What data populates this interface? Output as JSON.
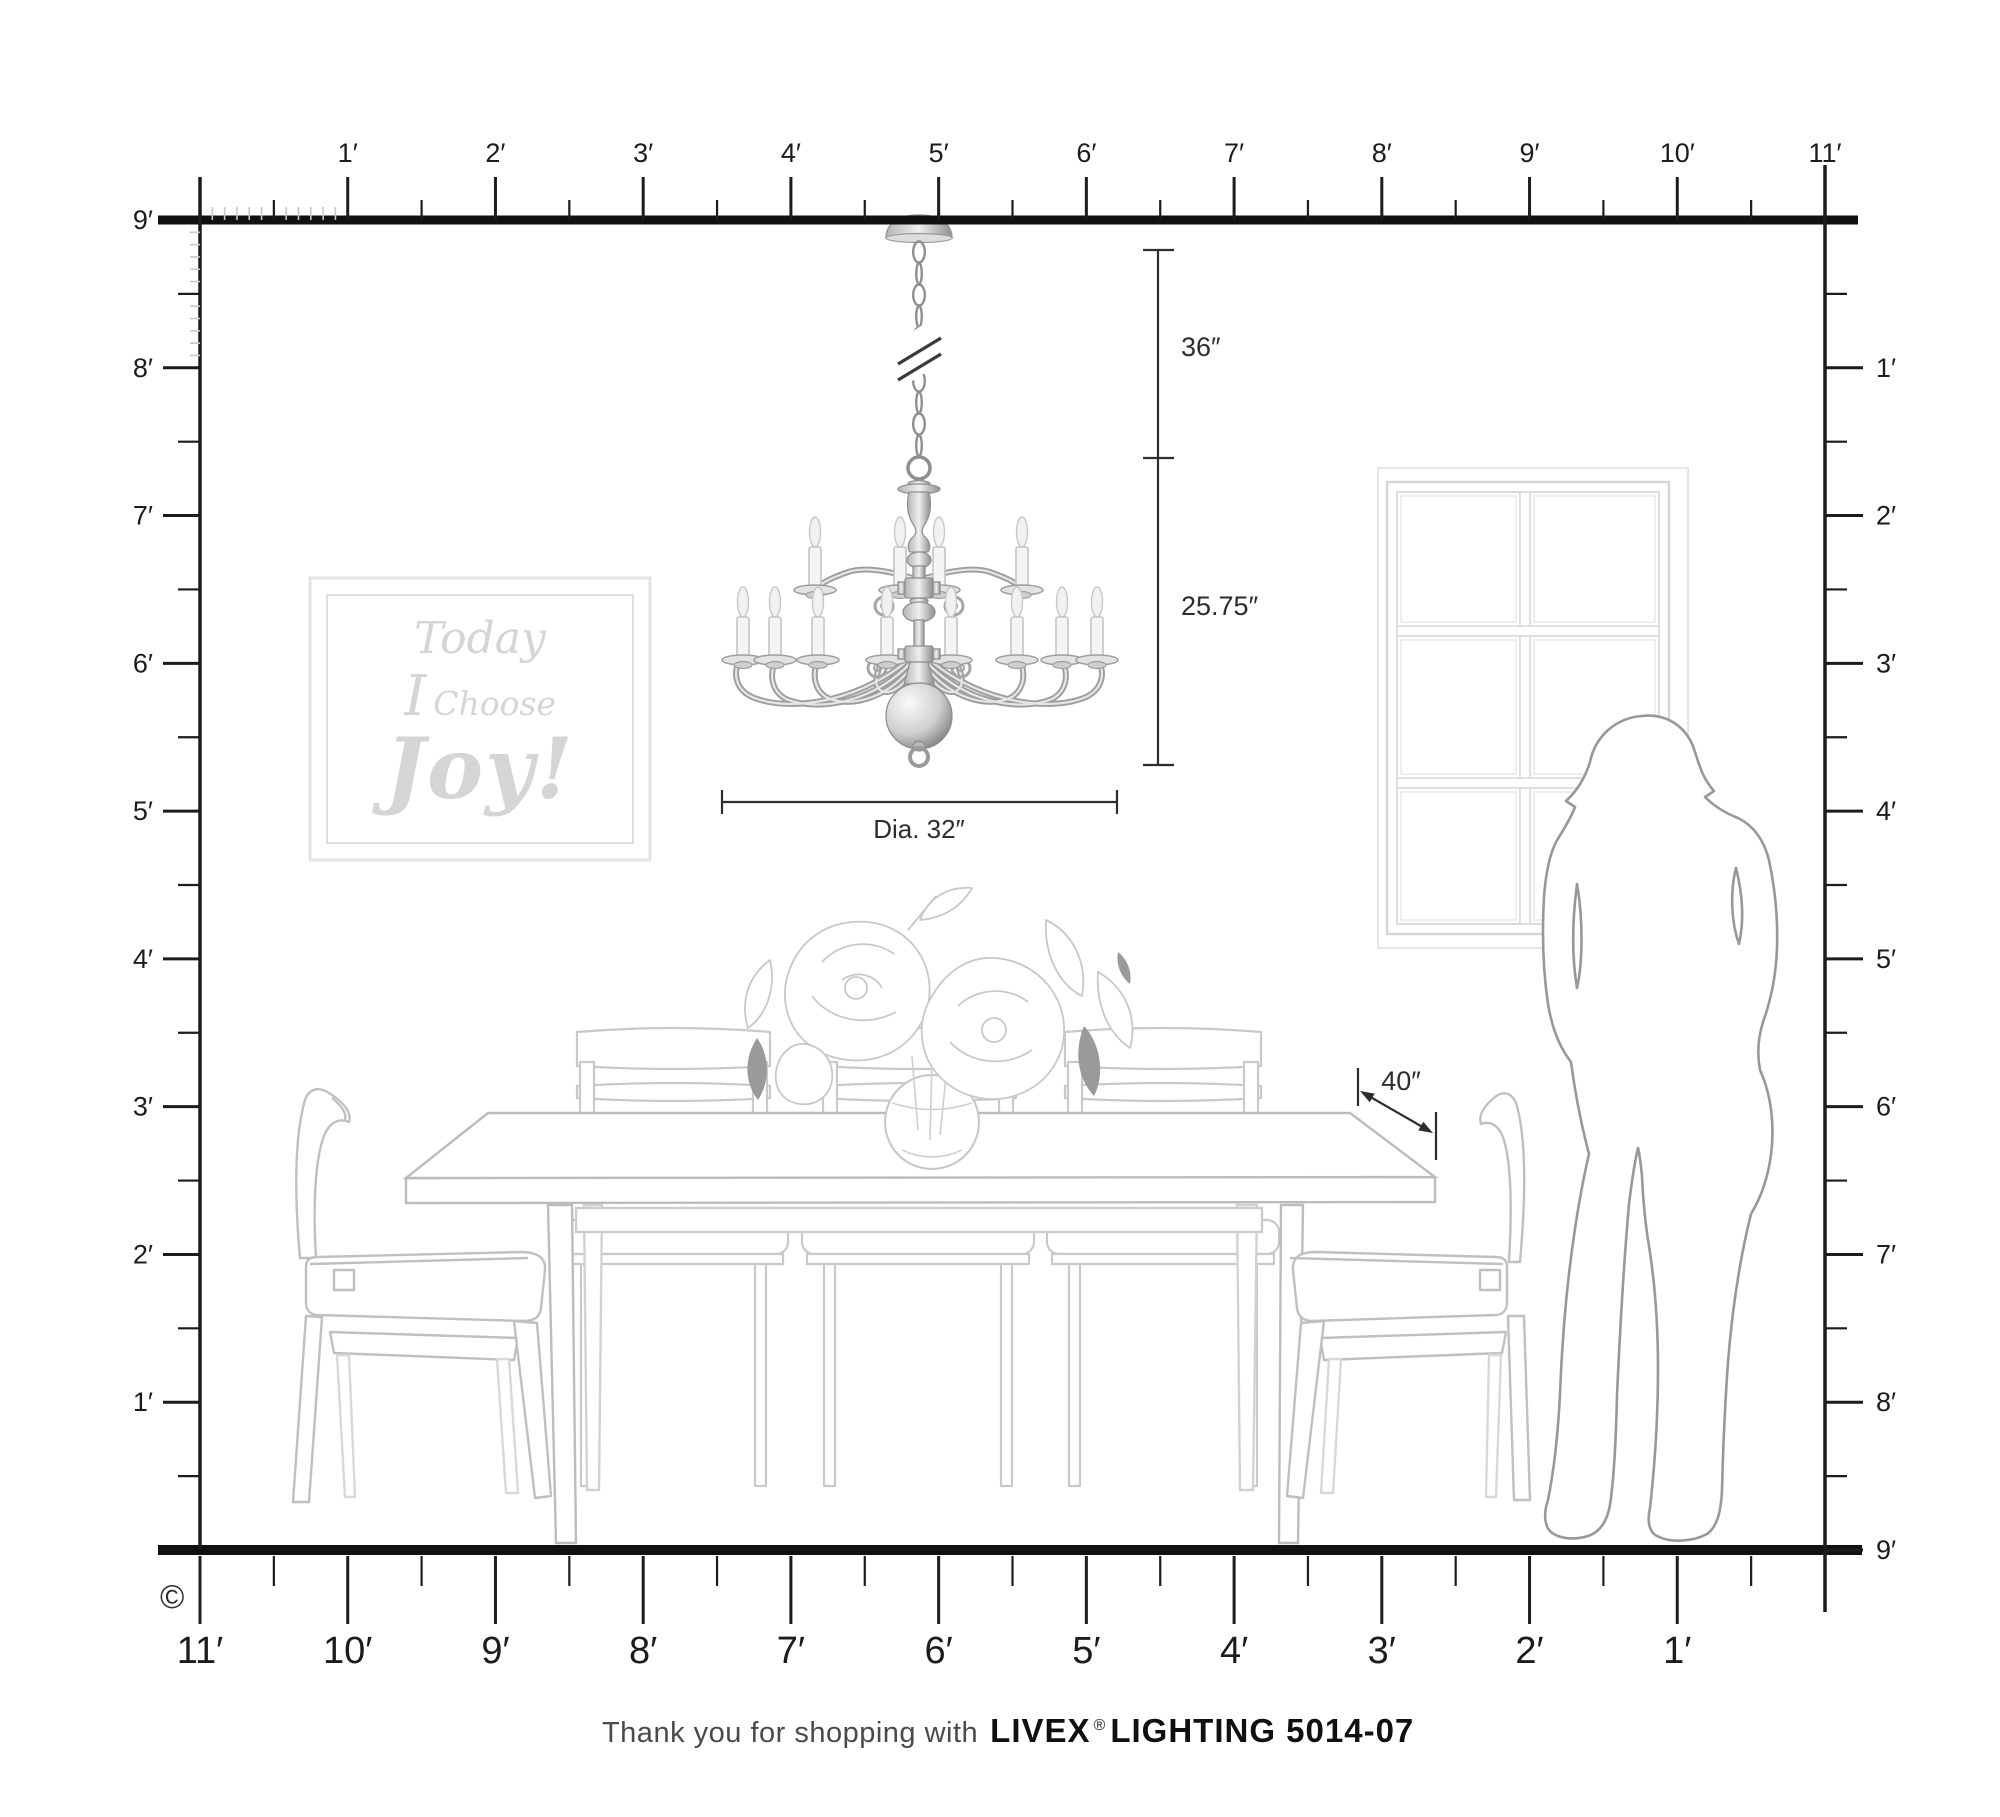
{
  "rulers": {
    "top": {
      "labels": [
        "1′",
        "2′",
        "3′",
        "4′",
        "5′",
        "6′",
        "7′",
        "8′",
        "9′",
        "10′",
        "11′"
      ]
    },
    "left": {
      "labels": [
        "9′",
        "8′",
        "7′",
        "6′",
        "5′",
        "4′",
        "3′",
        "2′",
        "1′"
      ]
    },
    "right": {
      "labels": [
        "1′",
        "2′",
        "3′",
        "4′",
        "5′",
        "6′",
        "7′",
        "8′",
        "9′"
      ]
    },
    "bottom": {
      "labels": [
        "11′",
        "10′",
        "9′",
        "8′",
        "7′",
        "6′",
        "5′",
        "4′",
        "3′",
        "2′",
        "1′"
      ]
    }
  },
  "dimensions": {
    "chain_length": "36″",
    "fixture_height": "25.75″",
    "diameter": "Dia. 32″",
    "table_clearance": "40″"
  },
  "wall_art": {
    "line1": "Today",
    "line2_word1": "I",
    "line2_word2": "Choose",
    "line3": "Joy!"
  },
  "footer": {
    "message": "Thank you for shopping with",
    "brand": "LIVEX",
    "registered_mark": "®",
    "product": "LIGHTING 5014-07"
  },
  "copyright": "©",
  "colors": {
    "ruler": "#1c1c1c",
    "dimension": "#2d2d2d",
    "furniture_line": "#c2c2c2",
    "silhouette_line": "#989898",
    "artwork_text": "#d5d5d5",
    "window_line": "#dcdcdc",
    "dark_leaf": "#9a9a9a"
  }
}
